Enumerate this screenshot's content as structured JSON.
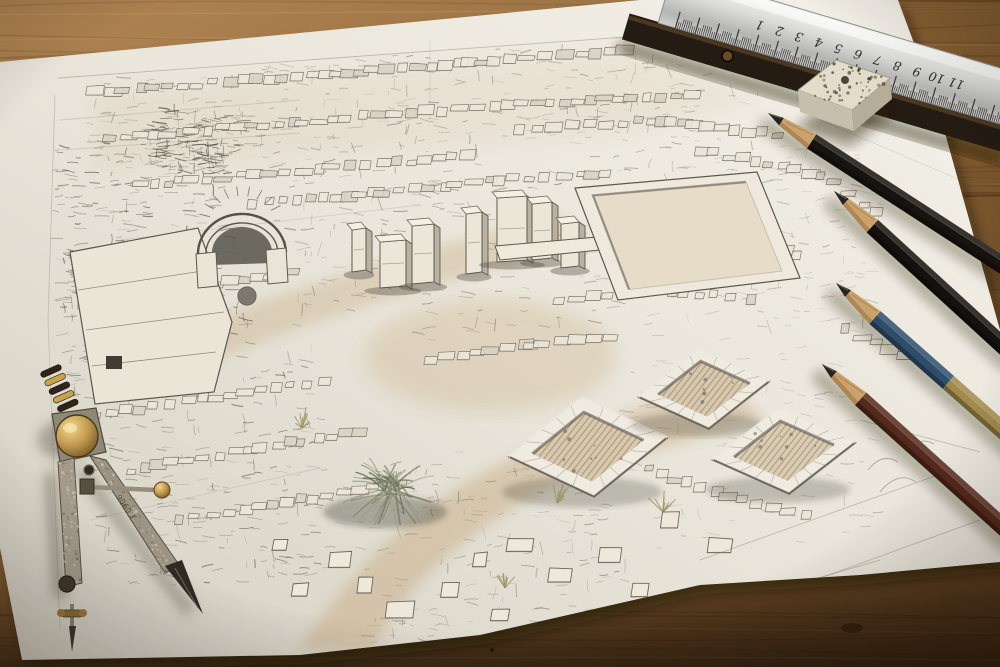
{
  "scene": {
    "type": "photograph",
    "description": "Detailed graphite pencil sketch of ancient ruins seen from above, drawn on a sheet of paper lying on a worn wooden desk, surrounded by drafting tools",
    "desk_surface": "worn wooden tabletop"
  },
  "paper": {
    "kind": "sketch sheet",
    "tone": "#e9e4d9"
  },
  "sketch": {
    "subject": "archaeological ruined city, aerial perspective",
    "features": [
      "arched stone gateway",
      "standing pillars",
      "rows of ruined walls",
      "rectangular courtyard",
      "sunken square chambers",
      "winding earthen path",
      "shrub and grass tufts"
    ],
    "media": "graphite with light sepia wash",
    "wash_color": "#c3a87e",
    "line_color": "#6f695e"
  },
  "tools": {
    "ruler": {
      "name": "steel ruler",
      "numbers": [
        "1",
        "2",
        "3",
        "4",
        "5",
        "6",
        "7",
        "8",
        "9",
        "10",
        "11"
      ],
      "orientation": "numbers upside down",
      "face_color": "#d6d7d5",
      "back_color": "#241c12"
    },
    "eraser": {
      "name": "speckled eraser block",
      "top_color": "#e3dccb",
      "front_color": "#c6bfae",
      "side_color": "#b5ad9a"
    },
    "pencils": [
      {
        "name": "pencil-black-1",
        "body_color": "#17130f"
      },
      {
        "name": "pencil-black-2",
        "body_color": "#15110d"
      },
      {
        "name": "pencil-blue",
        "body_color": "#2e4d6b",
        "ferrule_color": "#a18a4b"
      },
      {
        "name": "pencil-brown",
        "body_color": "#55291d"
      }
    ],
    "compass": {
      "name": "vintage drafting compass",
      "engraving": "F.0906",
      "knob_color": "#b08c46",
      "steel_color": "#9a9283"
    }
  },
  "palette": {
    "wood_light": "#a87c4a",
    "wood_mid": "#7c5930",
    "wood_dark": "#4a2f15",
    "paper_light": "#f2eee6",
    "paper_shadow": "#cfc9bc"
  }
}
